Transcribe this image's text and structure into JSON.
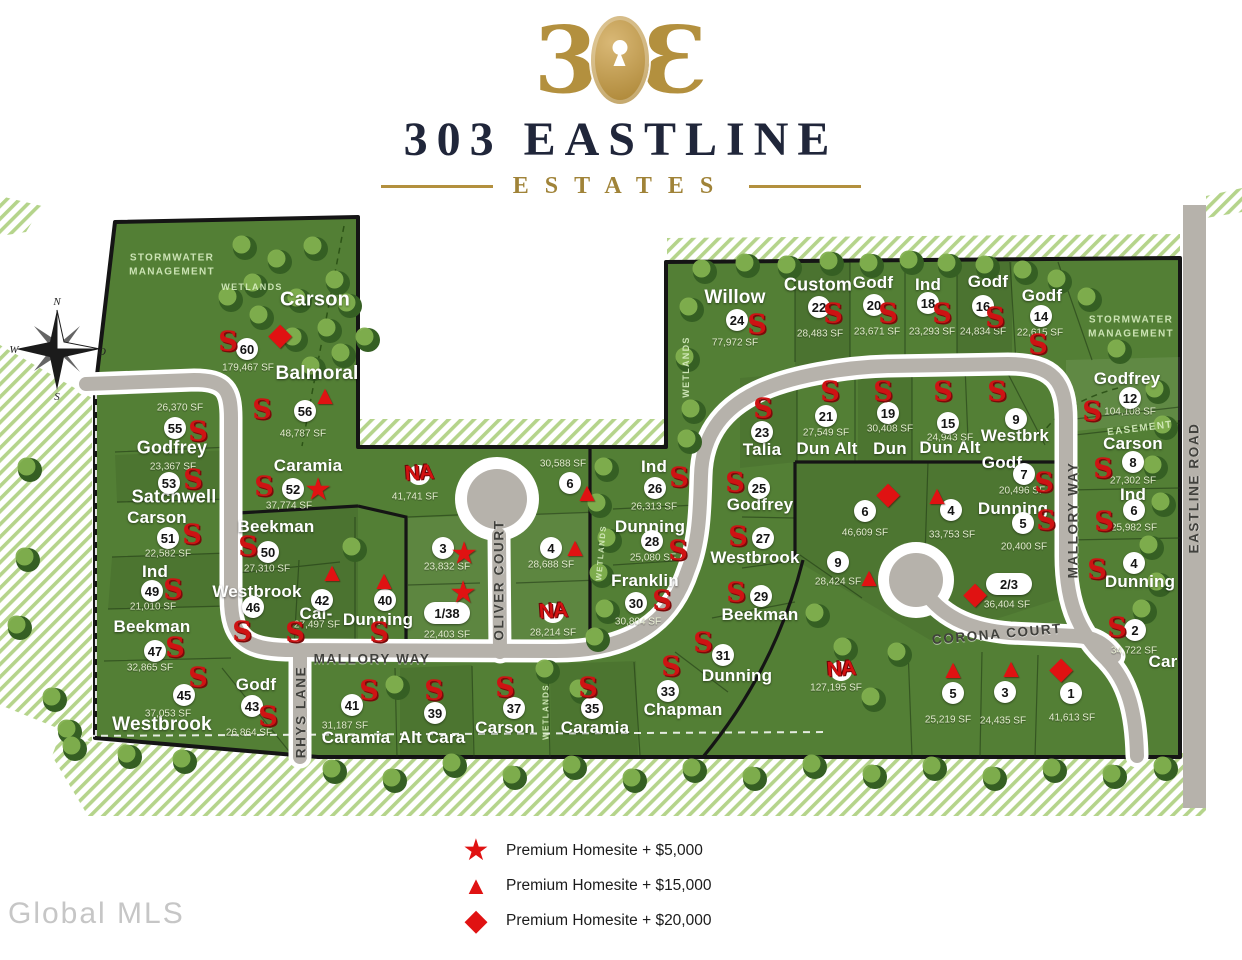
{
  "header": {
    "mark_left": "3",
    "mark_right": "Ɛ",
    "title": "303 EASTLINE",
    "subtitle": "ESTATES"
  },
  "watermark": "Global MLS",
  "compass": {
    "n": "N",
    "w": "W",
    "e": "O",
    "s": "S"
  },
  "colors": {
    "green": "#537f35",
    "road": "#b6b2ab",
    "accent_red": "#e01212",
    "gold": "#b3903e",
    "navy": "#20263a"
  },
  "legend": {
    "items": [
      {
        "icon": "premium-star-icon",
        "glyph": "★",
        "label": "Premium Homesite  + $5,000"
      },
      {
        "icon": "premium-triangle-icon",
        "glyph": "▲",
        "label": "Premium Homesite  + $15,000"
      },
      {
        "icon": "premium-diamond-icon",
        "glyph": "◆",
        "label": "Premium Homesite  + $20,000"
      }
    ]
  },
  "map": {
    "glyphs": {
      "s": "S",
      "star": "★",
      "tri": "▲",
      "dia": "◆",
      "na": "NA"
    },
    "labels": [
      {
        "t": "Carson",
        "x": 315,
        "y": 300,
        "c": "name",
        "fs": 20
      },
      {
        "t": "Balmoral",
        "x": 317,
        "y": 374,
        "c": "name",
        "fs": 19
      },
      {
        "t": "Godfrey",
        "x": 172,
        "y": 448,
        "c": "name",
        "fs": 18
      },
      {
        "t": "Satchwell",
        "x": 174,
        "y": 497,
        "c": "name",
        "fs": 18
      },
      {
        "t": "Carson",
        "x": 157,
        "y": 518,
        "c": "name"
      },
      {
        "t": "Ind",
        "x": 155,
        "y": 572,
        "c": "name"
      },
      {
        "t": "Beekman",
        "x": 152,
        "y": 627,
        "c": "name"
      },
      {
        "t": "Westbrook",
        "x": 162,
        "y": 725,
        "c": "name",
        "fs": 19
      },
      {
        "t": "Godf",
        "x": 256,
        "y": 685,
        "c": "name"
      },
      {
        "t": "Caramia",
        "x": 308,
        "y": 466,
        "c": "name"
      },
      {
        "t": "Beekman",
        "x": 276,
        "y": 527,
        "c": "name"
      },
      {
        "t": "Westbrook",
        "x": 257,
        "y": 592,
        "c": "name"
      },
      {
        "t": "Cal-",
        "x": 316,
        "y": 614,
        "c": "name"
      },
      {
        "t": "Dunning",
        "x": 378,
        "y": 620,
        "c": "name"
      },
      {
        "t": "Caramia",
        "x": 356,
        "y": 738,
        "c": "name"
      },
      {
        "t": "Alt Cara",
        "x": 432,
        "y": 738,
        "c": "name"
      },
      {
        "t": "Carson",
        "x": 505,
        "y": 728,
        "c": "name"
      },
      {
        "t": "Caramia",
        "x": 595,
        "y": 728,
        "c": "name"
      },
      {
        "t": "Ind",
        "x": 654,
        "y": 467,
        "c": "name"
      },
      {
        "t": "Dunning",
        "x": 650,
        "y": 527,
        "c": "name"
      },
      {
        "t": "Franklin",
        "x": 645,
        "y": 581,
        "c": "name"
      },
      {
        "t": "Willow",
        "x": 735,
        "y": 298,
        "c": "name",
        "fs": 19
      },
      {
        "t": "Custom",
        "x": 818,
        "y": 285,
        "c": "name",
        "fs": 18
      },
      {
        "t": "Godf",
        "x": 873,
        "y": 283,
        "c": "name"
      },
      {
        "t": "Ind",
        "x": 928,
        "y": 285,
        "c": "name"
      },
      {
        "t": "Godf",
        "x": 988,
        "y": 282,
        "c": "name"
      },
      {
        "t": "Godf",
        "x": 1042,
        "y": 296,
        "c": "name"
      },
      {
        "t": "Godfrey",
        "x": 1127,
        "y": 379,
        "c": "name"
      },
      {
        "t": "Carson",
        "x": 1133,
        "y": 444,
        "c": "name"
      },
      {
        "t": "Ind",
        "x": 1133,
        "y": 495,
        "c": "name"
      },
      {
        "t": "Dunning",
        "x": 1140,
        "y": 582,
        "c": "name"
      },
      {
        "t": "Talia",
        "x": 762,
        "y": 450,
        "c": "name"
      },
      {
        "t": "Dun Alt",
        "x": 827,
        "y": 449,
        "c": "name"
      },
      {
        "t": "Dun",
        "x": 890,
        "y": 449,
        "c": "name"
      },
      {
        "t": "Dun Alt",
        "x": 950,
        "y": 448,
        "c": "name"
      },
      {
        "t": "Westbrk",
        "x": 1015,
        "y": 436,
        "c": "name"
      },
      {
        "t": "Godf",
        "x": 1002,
        "y": 463,
        "c": "name"
      },
      {
        "t": "Dunning",
        "x": 1013,
        "y": 509,
        "c": "name"
      },
      {
        "t": "Godfrey",
        "x": 760,
        "y": 505,
        "c": "name"
      },
      {
        "t": "Westbrook",
        "x": 755,
        "y": 558,
        "c": "name"
      },
      {
        "t": "Beekman",
        "x": 760,
        "y": 615,
        "c": "name"
      },
      {
        "t": "Dunning",
        "x": 737,
        "y": 676,
        "c": "name"
      },
      {
        "t": "Chapman",
        "x": 683,
        "y": 710,
        "c": "name"
      },
      {
        "t": "Car",
        "x": 1163,
        "y": 662,
        "c": "name"
      },
      {
        "t": "179,467 SF",
        "x": 248,
        "y": 368,
        "c": "sf"
      },
      {
        "t": "48,787 SF",
        "x": 303,
        "y": 434,
        "c": "sf"
      },
      {
        "t": "26,370 SF",
        "x": 180,
        "y": 408,
        "c": "sf"
      },
      {
        "t": "23,367 SF",
        "x": 173,
        "y": 467,
        "c": "sf"
      },
      {
        "t": "22,582 SF",
        "x": 168,
        "y": 554,
        "c": "sf"
      },
      {
        "t": "21,010 SF",
        "x": 153,
        "y": 607,
        "c": "sf"
      },
      {
        "t": "32,865 SF",
        "x": 150,
        "y": 668,
        "c": "sf"
      },
      {
        "t": "37,053 SF",
        "x": 168,
        "y": 714,
        "c": "sf"
      },
      {
        "t": "26,864 SF",
        "x": 249,
        "y": 733,
        "c": "sf"
      },
      {
        "t": "37,774 SF",
        "x": 289,
        "y": 506,
        "c": "sf"
      },
      {
        "t": "27,310 SF",
        "x": 267,
        "y": 569,
        "c": "sf"
      },
      {
        "t": "27,497 SF",
        "x": 317,
        "y": 625,
        "c": "sf"
      },
      {
        "t": "41,741 SF",
        "x": 415,
        "y": 497,
        "c": "sf"
      },
      {
        "t": "23,832 SF",
        "x": 447,
        "y": 567,
        "c": "sf"
      },
      {
        "t": "22,403 SF",
        "x": 447,
        "y": 635,
        "c": "sf"
      },
      {
        "t": "31,187 SF",
        "x": 345,
        "y": 726,
        "c": "sf"
      },
      {
        "t": "30,588 SF",
        "x": 563,
        "y": 464,
        "c": "sf"
      },
      {
        "t": "28,688 SF",
        "x": 551,
        "y": 565,
        "c": "sf"
      },
      {
        "t": "28,214 SF",
        "x": 553,
        "y": 633,
        "c": "sf"
      },
      {
        "t": "26,313 SF",
        "x": 654,
        "y": 507,
        "c": "sf"
      },
      {
        "t": "25,080 SF",
        "x": 653,
        "y": 558,
        "c": "sf"
      },
      {
        "t": "30,804 SF",
        "x": 638,
        "y": 622,
        "c": "sf"
      },
      {
        "t": "77,972 SF",
        "x": 735,
        "y": 343,
        "c": "sf"
      },
      {
        "t": "28,483 SF",
        "x": 820,
        "y": 334,
        "c": "sf"
      },
      {
        "t": "23,671 SF",
        "x": 877,
        "y": 332,
        "c": "sf"
      },
      {
        "t": "23,293 SF",
        "x": 932,
        "y": 332,
        "c": "sf"
      },
      {
        "t": "24,834 SF",
        "x": 983,
        "y": 332,
        "c": "sf"
      },
      {
        "t": "22,615 SF",
        "x": 1040,
        "y": 333,
        "c": "sf"
      },
      {
        "t": "104,108 SF",
        "x": 1130,
        "y": 412,
        "c": "sf"
      },
      {
        "t": "27,302 SF",
        "x": 1133,
        "y": 481,
        "c": "sf"
      },
      {
        "t": "25,982 SF",
        "x": 1134,
        "y": 528,
        "c": "sf"
      },
      {
        "t": "27,549 SF",
        "x": 826,
        "y": 433,
        "c": "sf"
      },
      {
        "t": "30,408 SF",
        "x": 890,
        "y": 429,
        "c": "sf"
      },
      {
        "t": "24,943 SF",
        "x": 950,
        "y": 438,
        "c": "sf"
      },
      {
        "t": "20,496 SF",
        "x": 1022,
        "y": 491,
        "c": "sf"
      },
      {
        "t": "20,400 SF",
        "x": 1024,
        "y": 547,
        "c": "sf"
      },
      {
        "t": "46,609 SF",
        "x": 865,
        "y": 533,
        "c": "sf"
      },
      {
        "t": "33,753 SF",
        "x": 952,
        "y": 535,
        "c": "sf"
      },
      {
        "t": "28,424 SF",
        "x": 838,
        "y": 582,
        "c": "sf"
      },
      {
        "t": "36,404 SF",
        "x": 1007,
        "y": 605,
        "c": "sf"
      },
      {
        "t": "127,195 SF",
        "x": 836,
        "y": 688,
        "c": "sf"
      },
      {
        "t": "25,219 SF",
        "x": 948,
        "y": 720,
        "c": "sf"
      },
      {
        "t": "24,435 SF",
        "x": 1003,
        "y": 721,
        "c": "sf"
      },
      {
        "t": "41,613 SF",
        "x": 1072,
        "y": 718,
        "c": "sf"
      },
      {
        "t": "34,722 SF",
        "x": 1134,
        "y": 651,
        "c": "sf"
      },
      {
        "t": "STORMWATER\nMANAGEMENT",
        "x": 172,
        "y": 265,
        "c": "area"
      },
      {
        "t": "WETLANDS",
        "x": 252,
        "y": 287,
        "c": "area",
        "fs": 9
      },
      {
        "t": "STORMWATER\nMANAGEMENT",
        "x": 1131,
        "y": 327,
        "c": "area"
      },
      {
        "t": "EASEMENT",
        "x": 1140,
        "y": 429,
        "c": "area",
        "r": -7
      },
      {
        "t": "WETLANDS",
        "x": 686,
        "y": 367,
        "c": "area",
        "r": -90,
        "fs": 9
      },
      {
        "t": "WETLANDS",
        "x": 547,
        "y": 712,
        "c": "area",
        "r": -90,
        "fs": 8
      },
      {
        "t": "WETLANDS",
        "x": 602,
        "y": 553,
        "c": "area",
        "r": -85,
        "fs": 8
      },
      {
        "t": "MALLORY WAY",
        "x": 372,
        "y": 659,
        "c": "street"
      },
      {
        "t": "OLIVER COURT",
        "x": 499,
        "y": 580,
        "c": "street",
        "r": -90
      },
      {
        "t": "RHYS LANE",
        "x": 301,
        "y": 712,
        "c": "street",
        "r": -90
      },
      {
        "t": "CORONA COURT",
        "x": 997,
        "y": 634,
        "c": "street",
        "r": -5
      },
      {
        "t": "MALLORY WAY",
        "x": 1073,
        "y": 520,
        "c": "street",
        "r": -90
      },
      {
        "t": "EASTLINE ROAD",
        "x": 1194,
        "y": 488,
        "c": "street",
        "r": -90
      }
    ],
    "numbers": [
      {
        "t": "60",
        "x": 247,
        "y": 349
      },
      {
        "t": "56",
        "x": 305,
        "y": 411
      },
      {
        "t": "55",
        "x": 175,
        "y": 428
      },
      {
        "t": "53",
        "x": 169,
        "y": 483
      },
      {
        "t": "51",
        "x": 168,
        "y": 538
      },
      {
        "t": "49",
        "x": 152,
        "y": 591
      },
      {
        "t": "47",
        "x": 155,
        "y": 651
      },
      {
        "t": "45",
        "x": 184,
        "y": 695
      },
      {
        "t": "43",
        "x": 252,
        "y": 706
      },
      {
        "t": "52",
        "x": 293,
        "y": 489
      },
      {
        "t": "50",
        "x": 268,
        "y": 552
      },
      {
        "t": "46",
        "x": 253,
        "y": 607
      },
      {
        "t": "42",
        "x": 322,
        "y": 600
      },
      {
        "t": "40",
        "x": 385,
        "y": 600
      },
      {
        "t": "3",
        "x": 443,
        "y": 548
      },
      {
        "t": "1/38",
        "x": 447,
        "y": 613
      },
      {
        "t": "6",
        "x": 570,
        "y": 483
      },
      {
        "t": "4",
        "x": 551,
        "y": 548
      },
      {
        "t": "26",
        "x": 655,
        "y": 488
      },
      {
        "t": "28",
        "x": 652,
        "y": 541
      },
      {
        "t": "30",
        "x": 636,
        "y": 603
      },
      {
        "t": "24",
        "x": 737,
        "y": 320
      },
      {
        "t": "22",
        "x": 819,
        "y": 307
      },
      {
        "t": "20",
        "x": 874,
        "y": 305
      },
      {
        "t": "18",
        "x": 928,
        "y": 303
      },
      {
        "t": "16",
        "x": 983,
        "y": 306
      },
      {
        "t": "14",
        "x": 1041,
        "y": 316
      },
      {
        "t": "12",
        "x": 1130,
        "y": 398
      },
      {
        "t": "8",
        "x": 1133,
        "y": 462
      },
      {
        "t": "6",
        "x": 1134,
        "y": 510
      },
      {
        "t": "4",
        "x": 1134,
        "y": 563
      },
      {
        "t": "23",
        "x": 762,
        "y": 432
      },
      {
        "t": "21",
        "x": 826,
        "y": 416
      },
      {
        "t": "19",
        "x": 888,
        "y": 413
      },
      {
        "t": "15",
        "x": 948,
        "y": 423
      },
      {
        "t": "9",
        "x": 1016,
        "y": 419
      },
      {
        "t": "7",
        "x": 1024,
        "y": 474
      },
      {
        "t": "5",
        "x": 1023,
        "y": 523
      },
      {
        "t": "2/3",
        "x": 1009,
        "y": 584
      },
      {
        "t": "25",
        "x": 759,
        "y": 488
      },
      {
        "t": "27",
        "x": 763,
        "y": 538
      },
      {
        "t": "29",
        "x": 761,
        "y": 596
      },
      {
        "t": "31",
        "x": 723,
        "y": 655
      },
      {
        "t": "33",
        "x": 668,
        "y": 691
      },
      {
        "t": "6",
        "x": 865,
        "y": 511
      },
      {
        "t": "4",
        "x": 951,
        "y": 510
      },
      {
        "t": "9",
        "x": 838,
        "y": 562
      },
      {
        "t": "5",
        "x": 953,
        "y": 693
      },
      {
        "t": "3",
        "x": 1005,
        "y": 692
      },
      {
        "t": "1",
        "x": 1071,
        "y": 693
      },
      {
        "t": "2",
        "x": 1135,
        "y": 630
      },
      {
        "t": "41",
        "x": 352,
        "y": 705
      },
      {
        "t": "39",
        "x": 435,
        "y": 713
      },
      {
        "t": "37",
        "x": 514,
        "y": 708
      },
      {
        "t": "35",
        "x": 592,
        "y": 708
      }
    ],
    "symbols": [
      {
        "k": "s",
        "x": 228,
        "y": 342
      },
      {
        "k": "s",
        "x": 262,
        "y": 410
      },
      {
        "k": "s",
        "x": 198,
        "y": 432
      },
      {
        "k": "s",
        "x": 193,
        "y": 480
      },
      {
        "k": "s",
        "x": 192,
        "y": 535
      },
      {
        "k": "s",
        "x": 173,
        "y": 590
      },
      {
        "k": "s",
        "x": 175,
        "y": 648
      },
      {
        "k": "s",
        "x": 198,
        "y": 678
      },
      {
        "k": "s",
        "x": 268,
        "y": 717
      },
      {
        "k": "s",
        "x": 264,
        "y": 487
      },
      {
        "k": "s",
        "x": 248,
        "y": 547
      },
      {
        "k": "s",
        "x": 242,
        "y": 632
      },
      {
        "k": "s",
        "x": 295,
        "y": 633
      },
      {
        "k": "s",
        "x": 379,
        "y": 633
      },
      {
        "k": "s",
        "x": 369,
        "y": 691
      },
      {
        "k": "s",
        "x": 434,
        "y": 691
      },
      {
        "k": "s",
        "x": 505,
        "y": 688
      },
      {
        "k": "s",
        "x": 588,
        "y": 688
      },
      {
        "k": "s",
        "x": 679,
        "y": 478
      },
      {
        "k": "s",
        "x": 678,
        "y": 551
      },
      {
        "k": "s",
        "x": 662,
        "y": 601
      },
      {
        "k": "s",
        "x": 757,
        "y": 325
      },
      {
        "k": "s",
        "x": 833,
        "y": 314
      },
      {
        "k": "s",
        "x": 888,
        "y": 314
      },
      {
        "k": "s",
        "x": 942,
        "y": 314
      },
      {
        "k": "s",
        "x": 995,
        "y": 318
      },
      {
        "k": "s",
        "x": 1038,
        "y": 345
      },
      {
        "k": "s",
        "x": 1092,
        "y": 412
      },
      {
        "k": "s",
        "x": 1103,
        "y": 469
      },
      {
        "k": "s",
        "x": 1104,
        "y": 522
      },
      {
        "k": "s",
        "x": 1097,
        "y": 570
      },
      {
        "k": "s",
        "x": 763,
        "y": 409
      },
      {
        "k": "s",
        "x": 830,
        "y": 392
      },
      {
        "k": "s",
        "x": 883,
        "y": 392
      },
      {
        "k": "s",
        "x": 943,
        "y": 392
      },
      {
        "k": "s",
        "x": 997,
        "y": 392
      },
      {
        "k": "s",
        "x": 1044,
        "y": 483
      },
      {
        "k": "s",
        "x": 1046,
        "y": 521
      },
      {
        "k": "s",
        "x": 735,
        "y": 483
      },
      {
        "k": "s",
        "x": 738,
        "y": 537
      },
      {
        "k": "s",
        "x": 736,
        "y": 593
      },
      {
        "k": "s",
        "x": 703,
        "y": 643
      },
      {
        "k": "s",
        "x": 671,
        "y": 667
      },
      {
        "k": "s",
        "x": 1117,
        "y": 628
      },
      {
        "k": "star",
        "x": 318,
        "y": 489
      },
      {
        "k": "star",
        "x": 464,
        "y": 553
      },
      {
        "k": "star",
        "x": 463,
        "y": 592
      },
      {
        "k": "tri",
        "x": 325,
        "y": 395
      },
      {
        "k": "tri",
        "x": 332,
        "y": 572
      },
      {
        "k": "tri",
        "x": 384,
        "y": 580
      },
      {
        "k": "tri",
        "x": 587,
        "y": 492
      },
      {
        "k": "tri",
        "x": 575,
        "y": 547
      },
      {
        "k": "tri",
        "x": 937,
        "y": 495
      },
      {
        "k": "tri",
        "x": 869,
        "y": 577
      },
      {
        "k": "tri",
        "x": 953,
        "y": 669
      },
      {
        "k": "tri",
        "x": 1011,
        "y": 668
      },
      {
        "k": "dia",
        "x": 280,
        "y": 334
      },
      {
        "k": "dia",
        "x": 888,
        "y": 493
      },
      {
        "k": "dia",
        "x": 975,
        "y": 593
      },
      {
        "k": "dia",
        "x": 1061,
        "y": 668
      },
      {
        "k": "na",
        "x": 419,
        "y": 473
      },
      {
        "k": "na",
        "x": 553,
        "y": 611
      },
      {
        "k": "na",
        "x": 841,
        "y": 669
      }
    ]
  }
}
